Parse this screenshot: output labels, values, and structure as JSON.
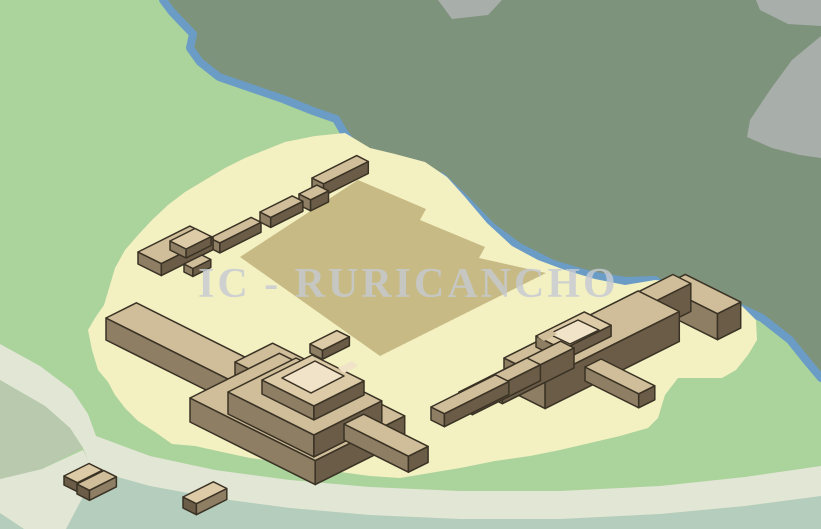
{
  "watermark": {
    "text": "IC - RURICANCHO"
  },
  "colors": {
    "lightGreen": "#abd39c",
    "darkGreen": "#7e937b",
    "gray": "#a8aeaa",
    "river": "#6b9cc6",
    "sand": "#f3f0c2",
    "plaza": "#c7ba84",
    "sage": "#b9c9ae",
    "teal": "#b4cdbd",
    "path": "#e2e6d5",
    "top": "#cfbe99",
    "topLight": "#ddcba7",
    "floor": "#f1e3c8",
    "sideSW": "#8d7e64",
    "sideSE": "#6a5c46",
    "outline": "#3a3224",
    "watermark": "#c6cbd2"
  }
}
